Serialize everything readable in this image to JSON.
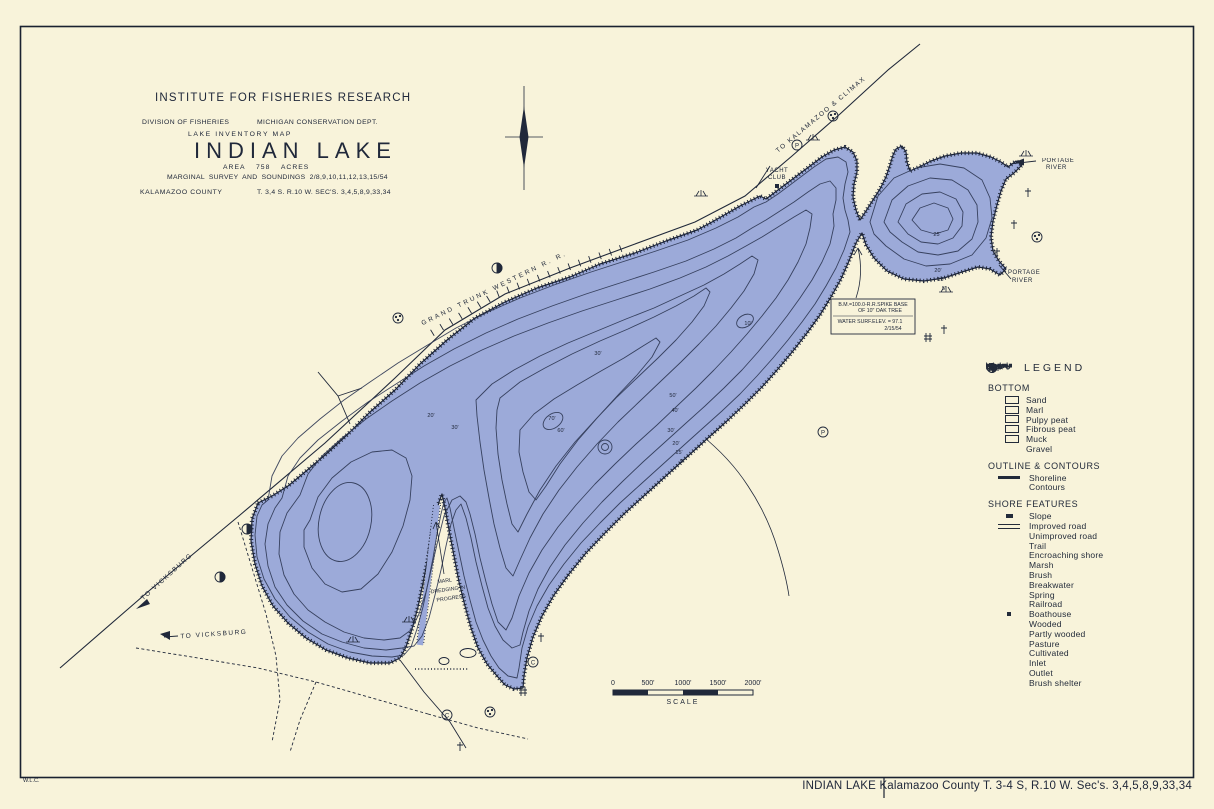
{
  "colors": {
    "paper": "#f8f3da",
    "lake": "#9aa8d9",
    "ink": "#232b3a",
    "contour": "#2e3854"
  },
  "title_block": {
    "institute": "INSTITUTE FOR FISHERIES RESEARCH",
    "division": "DIVISION OF FISHERIES",
    "dept": "MICHIGAN CONSERVATION DEPT.",
    "map_type": "LAKE INVENTORY MAP",
    "lake_name": "INDIAN LAKE",
    "area": "AREA 758 ACRES",
    "survey": "MARGINAL SURVEY AND SOUNDINGS 2/8,9,10,11,12,13,15/54",
    "county": "KALAMAZOO COUNTY",
    "township": "T. 3,4 S. R.10 W. SEC'S. 3,4,5,8,9,33,34"
  },
  "map_labels": {
    "railroad_sw": "TO VICKSBURG",
    "railroad_name": "GRAND TRUNK WESTERN R. R.",
    "railroad_ne": "TO KALAMAZOO & CLIMAX",
    "road_sw": "TO VICKSBURG",
    "yacht_club_1": "YACHT",
    "yacht_club_2": "CLUB",
    "portage_top_1": "PORTAGE",
    "portage_top_2": "RIVER",
    "portage_bottom_1": "PORTAGE",
    "portage_bottom_2": "RIVER",
    "marl_1": "MARL",
    "marl_2": "DREDGING IN",
    "marl_3": "PROGRESS",
    "benchmark_1": "B.M.=100.0-R.R.SPIKE BASE",
    "benchmark_2": "OF 10\" OAK TREE",
    "benchmark_3": "WATER SURF.ELEV. = 97.1",
    "benchmark_4": "2/15/54",
    "surveyor_initials": "W.L.C."
  },
  "map_symbols": {
    "pasture": "P",
    "cultivated": "C"
  },
  "depth_labels": [
    "70'",
    "60'",
    "50'",
    "40'",
    "30'",
    "20'",
    "15'",
    "5'",
    "30'",
    "20'",
    "10'",
    "25'",
    "20'",
    "15'",
    "5'",
    "30'"
  ],
  "legend": {
    "title": "LEGEND",
    "bottom": {
      "heading": "BOTTOM",
      "items": [
        "Sand",
        "Marl",
        "Pulpy peat",
        "Fibrous peat",
        "Muck",
        "Gravel"
      ]
    },
    "outline": {
      "heading": "OUTLINE & CONTOURS",
      "items": [
        "Shoreline",
        "Contours"
      ],
      "contour_label": "5'"
    },
    "shore": {
      "heading": "SHORE FEATURES",
      "items": [
        "Slope",
        "Improved road",
        "Unimproved road",
        "Trail",
        "Encroaching shore",
        "Marsh",
        "Brush",
        "Breakwater",
        "Spring",
        "Railroad",
        "Boathouse",
        "Wooded",
        "Partly wooded",
        "Pasture",
        "Cultivated",
        "Inlet",
        "Outlet",
        "Brush shelter"
      ],
      "pasture_letter": "P",
      "cultivated_letter": "C"
    }
  },
  "scale_bar": {
    "ticks": [
      "0",
      "500'",
      "1000'",
      "1500'",
      "2000'"
    ],
    "label": "SCALE"
  },
  "footer": {
    "title": "INDIAN LAKE  Kalamazoo County T. 3-4 S, R.10 W. Sec's. 3,4,5,8,9,33,34"
  }
}
